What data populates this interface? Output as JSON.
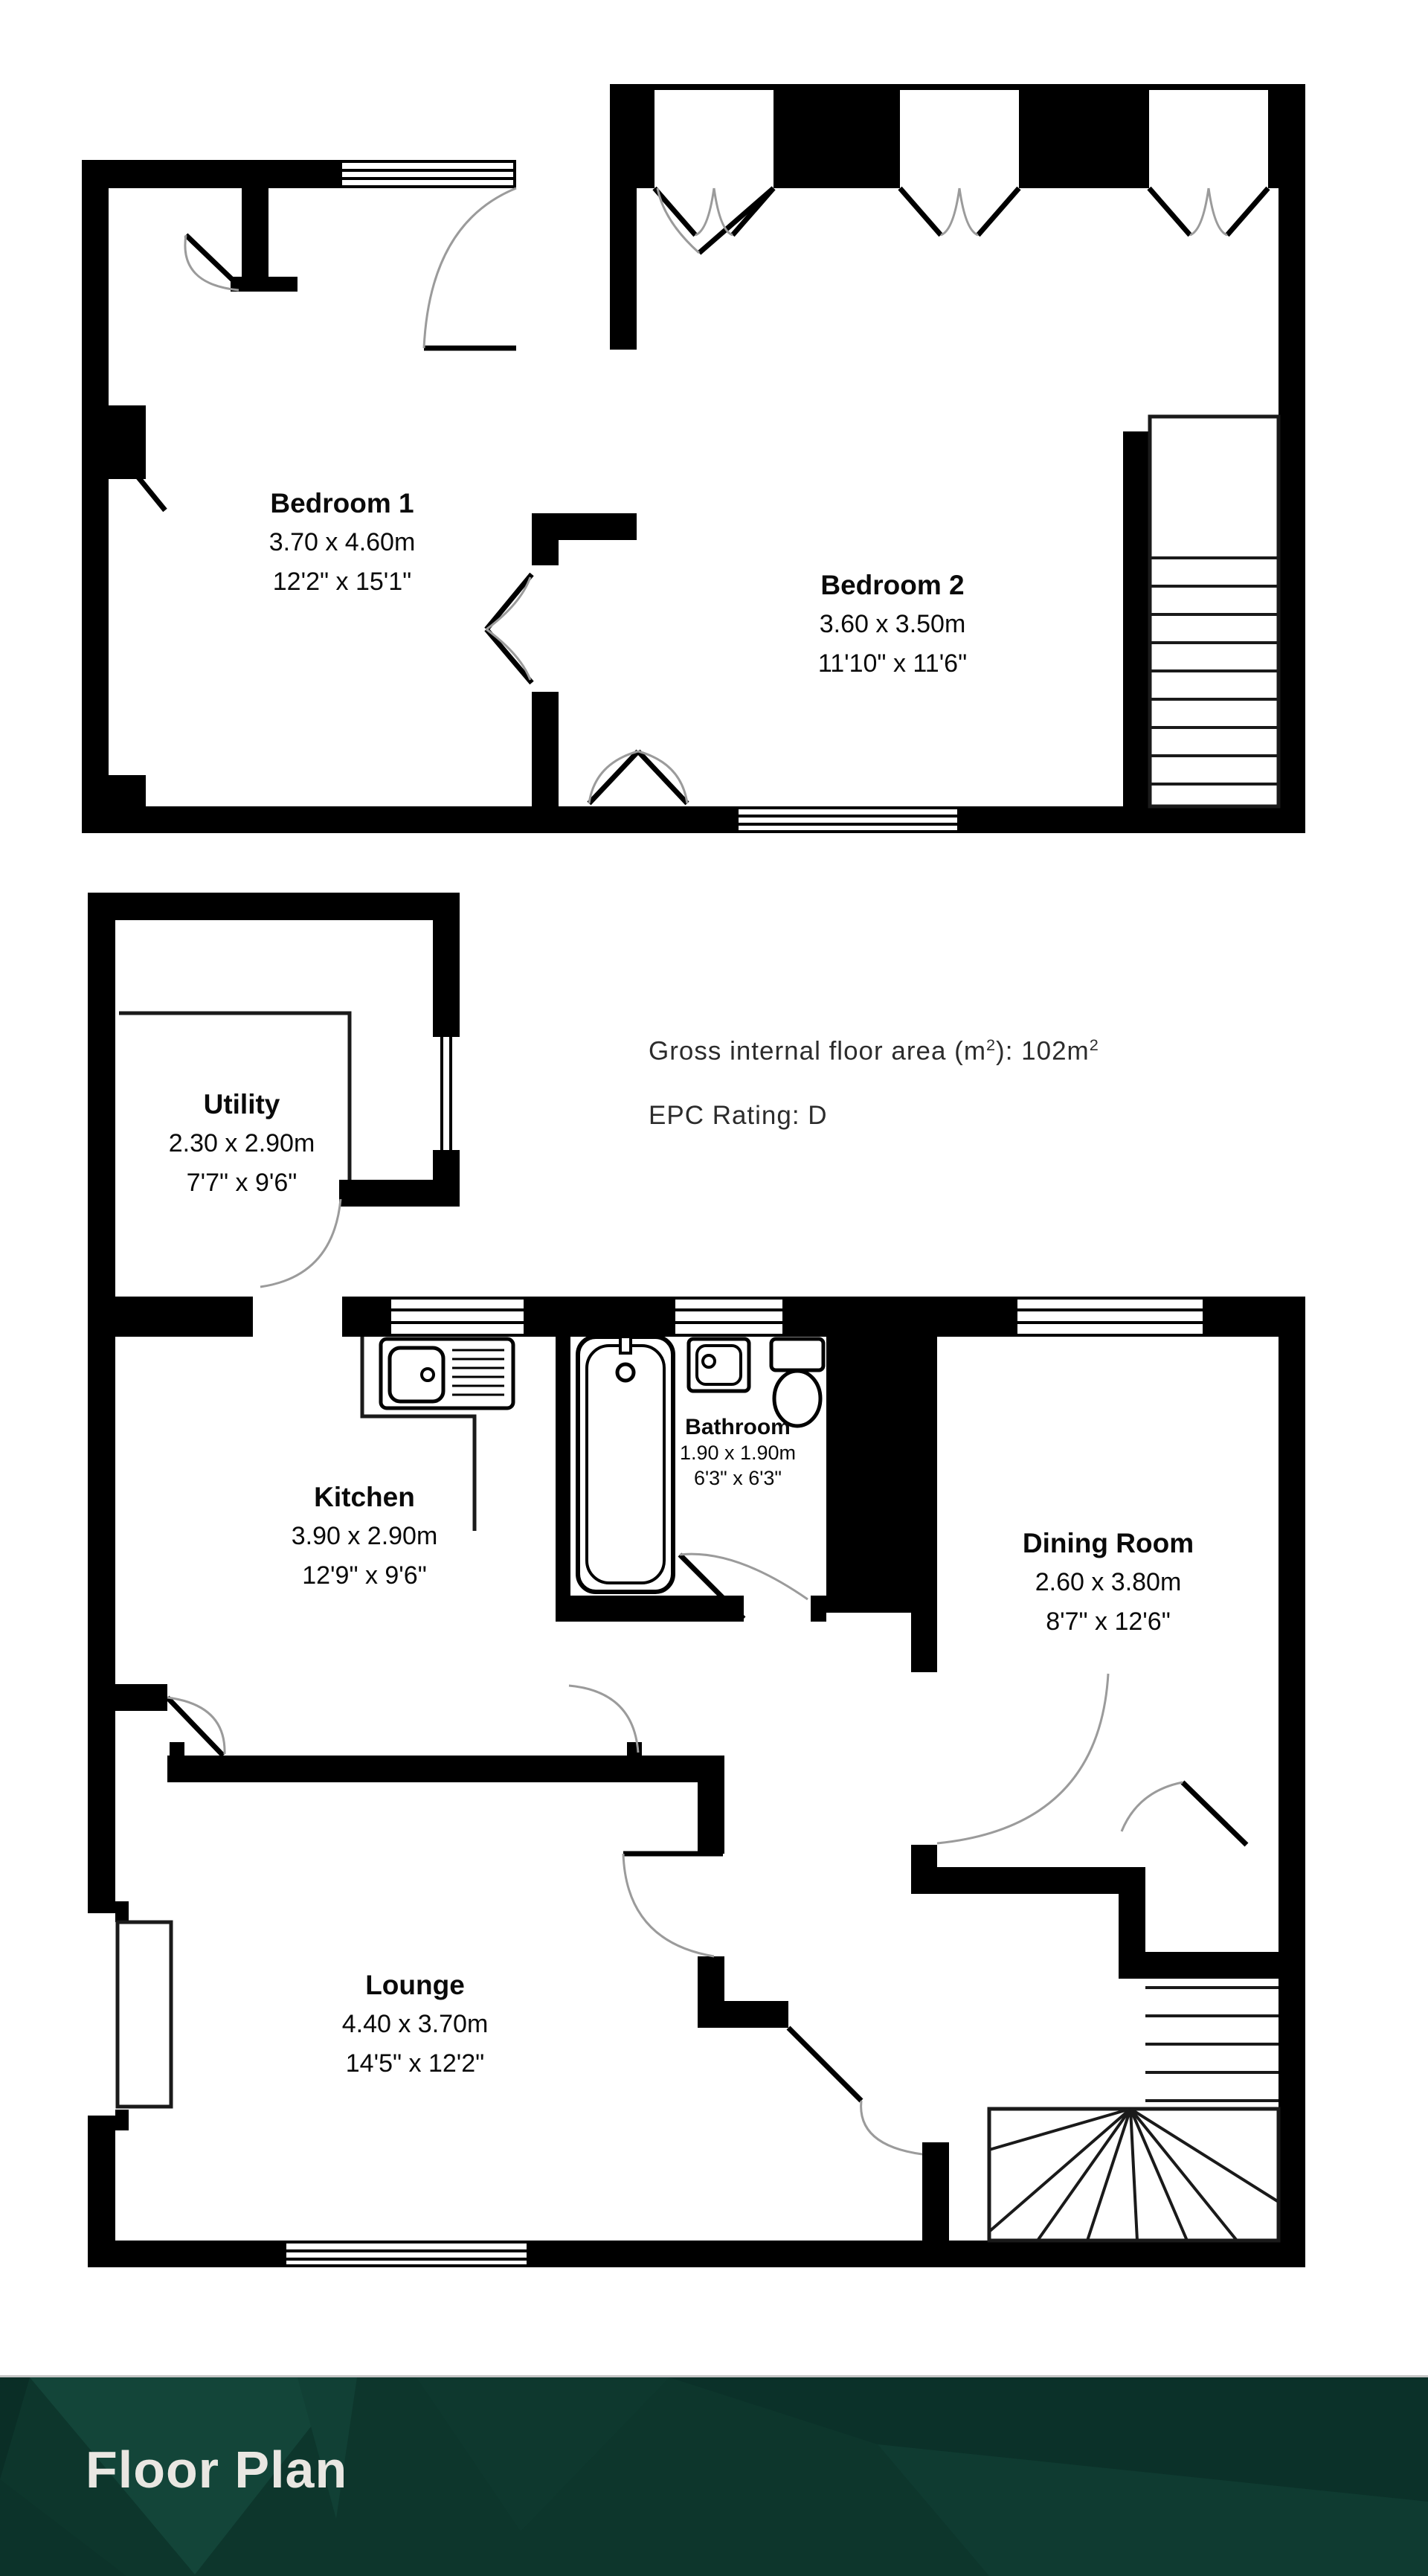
{
  "banner": {
    "title": "Floor Plan",
    "background": "#0d362c",
    "text_color": "#e9e7e2"
  },
  "info": {
    "gross_prefix": "Gross internal floor area (m",
    "gross_sup_a": "2",
    "gross_mid": "): 102m",
    "gross_sup_b": "2",
    "epc": "EPC Rating: D"
  },
  "rooms": [
    {
      "id": "bedroom-1",
      "name": "Bedroom 1",
      "metric": "3.70 x 4.60m",
      "imperial": "12'2\" x 15'1\""
    },
    {
      "id": "bedroom-2",
      "name": "Bedroom 2",
      "metric": "3.60 x 3.50m",
      "imperial": "11'10\" x 11'6\""
    },
    {
      "id": "utility",
      "name": "Utility",
      "metric": "2.30 x 2.90m",
      "imperial": "7'7\" x 9'6\""
    },
    {
      "id": "kitchen",
      "name": "Kitchen",
      "metric": "3.90 x 2.90m",
      "imperial": "12'9\" x 9'6\""
    },
    {
      "id": "bathroom",
      "name": "Bathroom",
      "metric": "1.90 x 1.90m",
      "imperial": "6'3\" x 6'3\""
    },
    {
      "id": "dining-room",
      "name": "Dining Room",
      "metric": "2.60 x 3.80m",
      "imperial": "8'7\" x 12'6\""
    },
    {
      "id": "lounge",
      "name": "Lounge",
      "metric": "4.40 x 3.70m",
      "imperial": "14'5\" x 12'2\""
    }
  ]
}
